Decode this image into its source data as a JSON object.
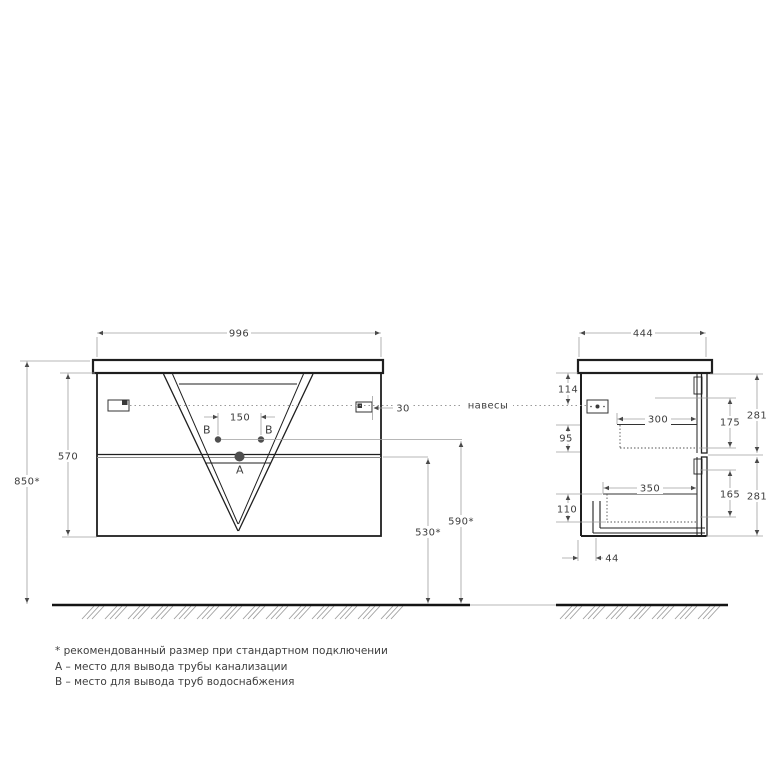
{
  "annotations": {
    "hangers_label": "навесы"
  },
  "front_view": {
    "width_label": "996",
    "body_height_label": "570",
    "mount_height_label": "850*",
    "supply_spacing_label": "150",
    "bracket_offset_label": "30",
    "supply_outlet_height_label": "590*",
    "drain_outlet_height_label": "530*",
    "point_a_label": "A",
    "point_b_left_label": "B",
    "point_b_right_label": "B"
  },
  "side_view": {
    "depth_label": "444",
    "bracket_from_top_label": "114",
    "slide_to_gap_label": "95",
    "drawer_bottom_offset_label": "110",
    "top_drawer_depth_label": "300",
    "bottom_drawer_depth_label": "350",
    "top_drawer_inner_height_label": "175",
    "bottom_drawer_inner_height_label": "165",
    "top_front_height_label": "281",
    "bottom_front_height_label": "281",
    "back_clearance_label": "44"
  },
  "footnotes": [
    "* рекомендованный размер при стандартном подключении",
    "А – место для вывода трубы канализации",
    "В – место для вывода труб водоснабжения"
  ]
}
